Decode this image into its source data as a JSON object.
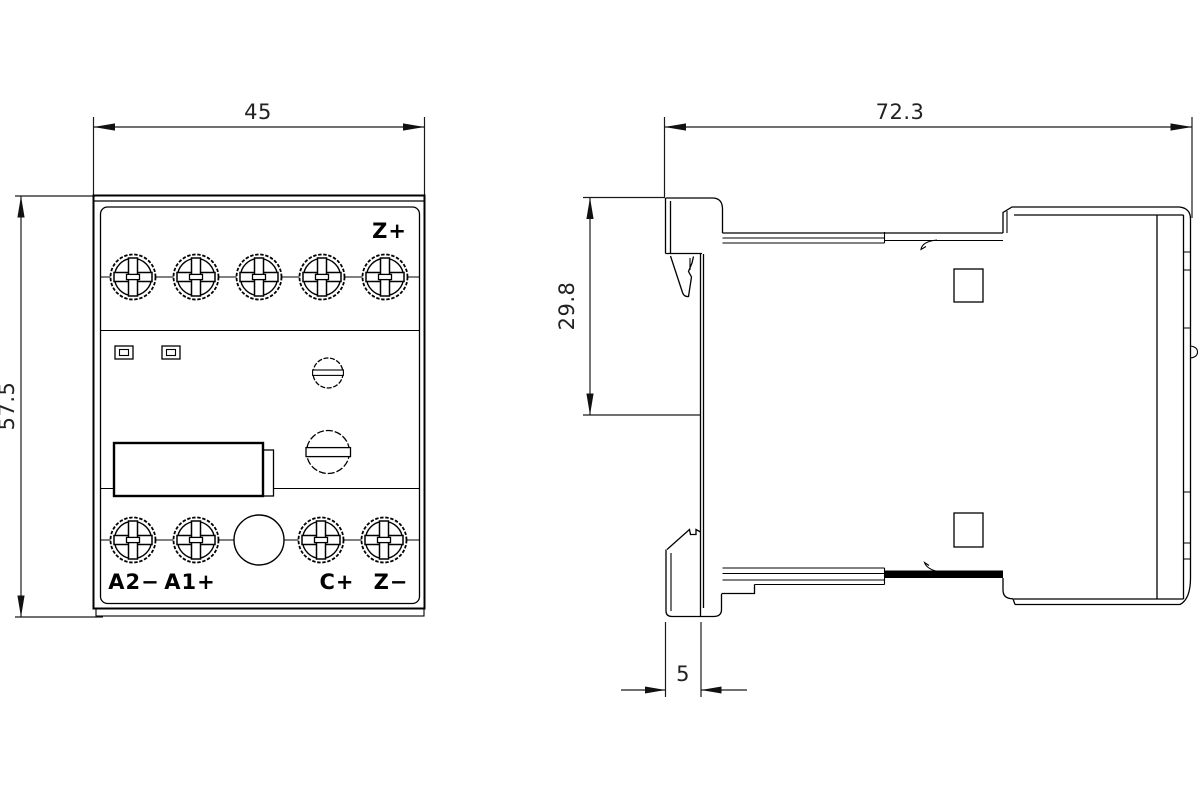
{
  "page": {
    "background": "#ffffff",
    "line_color": "#000000",
    "description": "Dimensional drawing, front view and side view of DIN-rail device"
  },
  "front_view": {
    "name": "front-view",
    "width_dim": "45",
    "height_dim": "57.5",
    "terminal_top_label": "Z+",
    "terminal_bottom_labels": [
      "A2−",
      "A1+",
      "C+",
      "Z−"
    ]
  },
  "side_view": {
    "name": "side-view",
    "depth_dim": "72.3",
    "upper_depth_dim": "29.8",
    "rail_dim": "5"
  }
}
